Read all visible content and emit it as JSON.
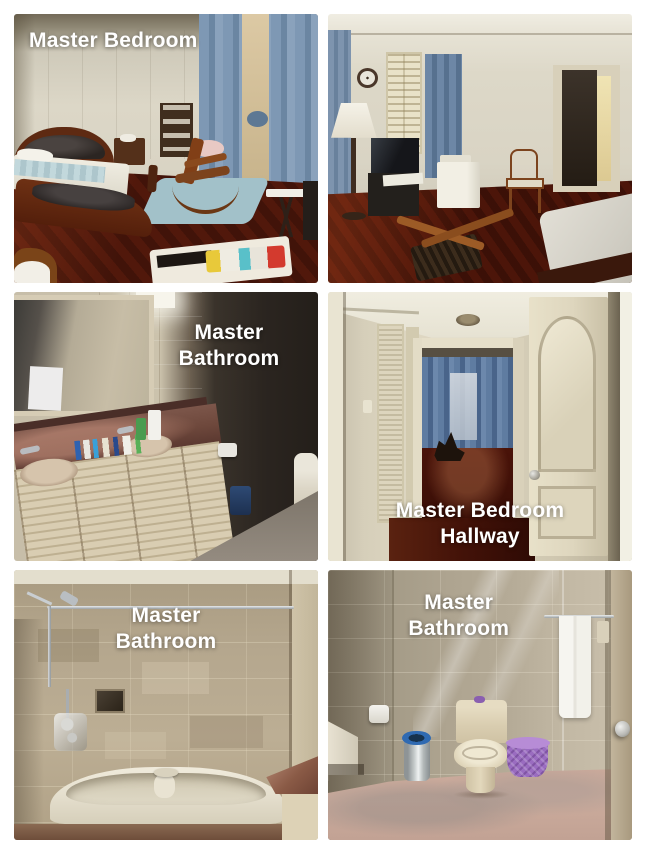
{
  "page": {
    "background_color": "#ffffff",
    "label_text_color": "#ffffff"
  },
  "collage": {
    "layout": "2-column 3-row photo grid",
    "photos": [
      {
        "name": "master-bedroom",
        "description": "Master bedroom with dark wood bed, blue curtains, rocking chair, bookshelf and red-brown parquet floor",
        "label_lines": [
          "Master Bedroom"
        ],
        "label_position": "top-left",
        "dominant_colors": [
          "#d9d4c4",
          "#7e98b4",
          "#51180b",
          "#5e2a12"
        ]
      },
      {
        "name": "master-bedroom-second-view",
        "description": "Master bedroom second view with floor lamp, TV, shutters, armchair, doorway and bed corner",
        "label_lines": [],
        "label_position": "none",
        "dominant_colors": [
          "#ddd8c8",
          "#6d87a6",
          "#4c1509"
        ]
      },
      {
        "name": "master-bathroom-vanity",
        "description": "Master bathroom double-sink vanity with large mirror, marble counter and dark tiled wall",
        "label_lines": [
          "Master",
          "Bathroom"
        ],
        "label_position": "top-right",
        "dominant_colors": [
          "#c7bea9",
          "#6e483c",
          "#241f1a",
          "#d9cdb2"
        ]
      },
      {
        "name": "master-bedroom-hallway",
        "description": "Hallway to master bedroom with cream doors, blue curtains at the end and dark wood floor",
        "label_lines": [
          "Master Bedroom",
          "Hallway"
        ],
        "label_position": "bottom-center",
        "dominant_colors": [
          "#d8d1bc",
          "#5f7ca1",
          "#431208"
        ]
      },
      {
        "name": "master-bathroom-tub",
        "description": "Master bathroom bathtub with travertine tile walls, chrome shower rod and marble counter corner",
        "label_lines": [
          "Master",
          "Bathroom"
        ],
        "label_position": "top-center",
        "dominant_colors": [
          "#b3a58c",
          "#e6e0cf",
          "#8a5a46"
        ]
      },
      {
        "name": "master-bathroom-toilet",
        "description": "Master bathroom toilet area with towel rail, purple basket, chrome bin and pink marble floor",
        "label_lines": [
          "Master",
          "Bathroom"
        ],
        "label_position": "top-center",
        "dominant_colors": [
          "#aea490",
          "#d9cdb0",
          "#9a6cc0",
          "#c8a89a"
        ]
      }
    ]
  }
}
